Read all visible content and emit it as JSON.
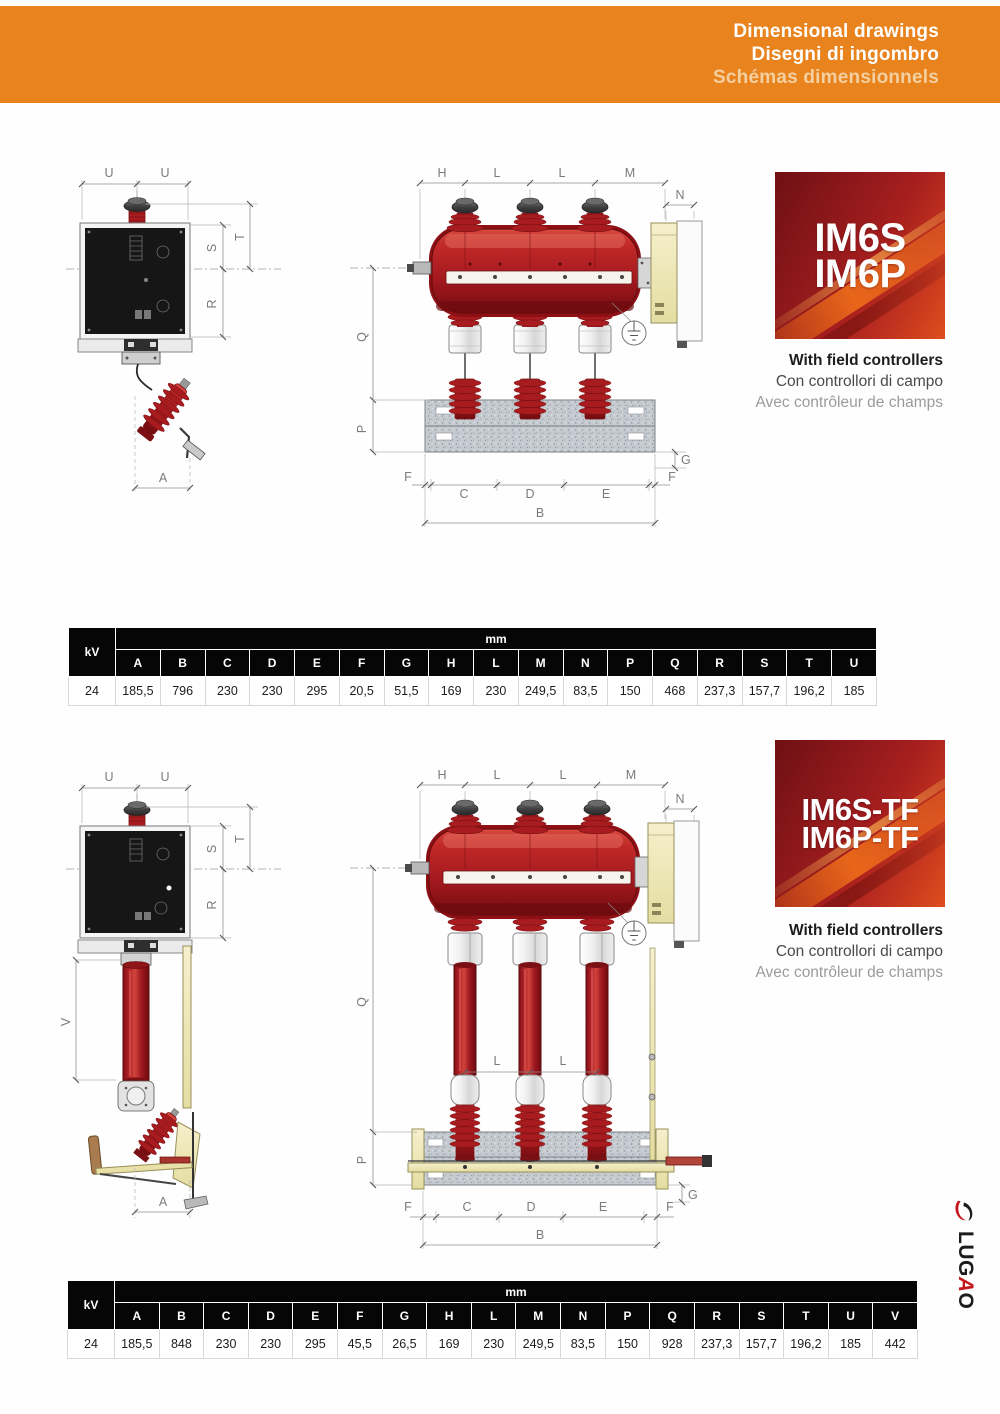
{
  "header": {
    "title_en": "Dimensional drawings",
    "title_it": "Disegni di ingombro",
    "title_fr": "Schémas dimensionnels"
  },
  "colors": {
    "header_orange": "#E8831D",
    "badge_red_dark": "#6E1013",
    "badge_red_bright": "#DE4E1D",
    "drawing_red": "#B01E24",
    "control_panel_black": "#161616",
    "control_box_cream": "#F1ECC4",
    "steel_gray": "#C6CBD1",
    "table_header": "#060606"
  },
  "sections": [
    {
      "badge": {
        "line1": "IM6S",
        "line2": "IM6P"
      },
      "caption": {
        "en": "With field controllers",
        "it": "Con controllori di campo",
        "fr": "Avec contrôleur de champs"
      },
      "table": {
        "kv_header": "kV",
        "unit_header": "mm",
        "kv_value": "24",
        "columns": [
          "A",
          "B",
          "C",
          "D",
          "E",
          "F",
          "G",
          "H",
          "L",
          "M",
          "N",
          "P",
          "Q",
          "R",
          "S",
          "T",
          "U"
        ],
        "values": [
          "185,5",
          "796",
          "230",
          "230",
          "295",
          "20,5",
          "51,5",
          "169",
          "230",
          "249,5",
          "83,5",
          "150",
          "468",
          "237,3",
          "157,7",
          "196,2",
          "185"
        ]
      },
      "side_labels": {
        "u1": "U",
        "u2": "U",
        "t": "T",
        "s": "S",
        "r": "R",
        "a": "A"
      },
      "front_labels": {
        "h": "H",
        "l1": "L",
        "l2": "L",
        "m": "M",
        "n": "N",
        "q": "Q",
        "p": "P",
        "g": "G",
        "f1": "F",
        "c": "C",
        "d": "D",
        "e": "E",
        "f2": "F",
        "b": "B"
      }
    },
    {
      "badge": {
        "line1": "IM6S-TF",
        "line2": "IM6P-TF"
      },
      "caption": {
        "en": "With field controllers",
        "it": "Con controllori di campo",
        "fr": "Avec contrôleur de champs"
      },
      "table": {
        "kv_header": "kV",
        "unit_header": "mm",
        "kv_value": "24",
        "columns": [
          "A",
          "B",
          "C",
          "D",
          "E",
          "F",
          "G",
          "H",
          "L",
          "M",
          "N",
          "P",
          "Q",
          "R",
          "S",
          "T",
          "U",
          "V"
        ],
        "values": [
          "185,5",
          "848",
          "230",
          "230",
          "295",
          "45,5",
          "26,5",
          "169",
          "230",
          "249,5",
          "83,5",
          "150",
          "928",
          "237,3",
          "157,7",
          "196,2",
          "185",
          "442"
        ]
      },
      "side_labels": {
        "u1": "U",
        "u2": "U",
        "t": "T",
        "s": "S",
        "r": "R",
        "v": "V",
        "a": "A"
      },
      "front_labels": {
        "h": "H",
        "l1": "L",
        "l2": "L",
        "m": "M",
        "n": "N",
        "l3": "L",
        "l4": "L",
        "q": "Q",
        "p": "P",
        "g": "G",
        "f1": "F",
        "c": "C",
        "d": "D",
        "e": "E",
        "f2": "F",
        "b": "B"
      }
    }
  ],
  "logo": {
    "text": "LUGAO",
    "prefix": "LUG",
    "accent": "A",
    "suffix": "O"
  }
}
